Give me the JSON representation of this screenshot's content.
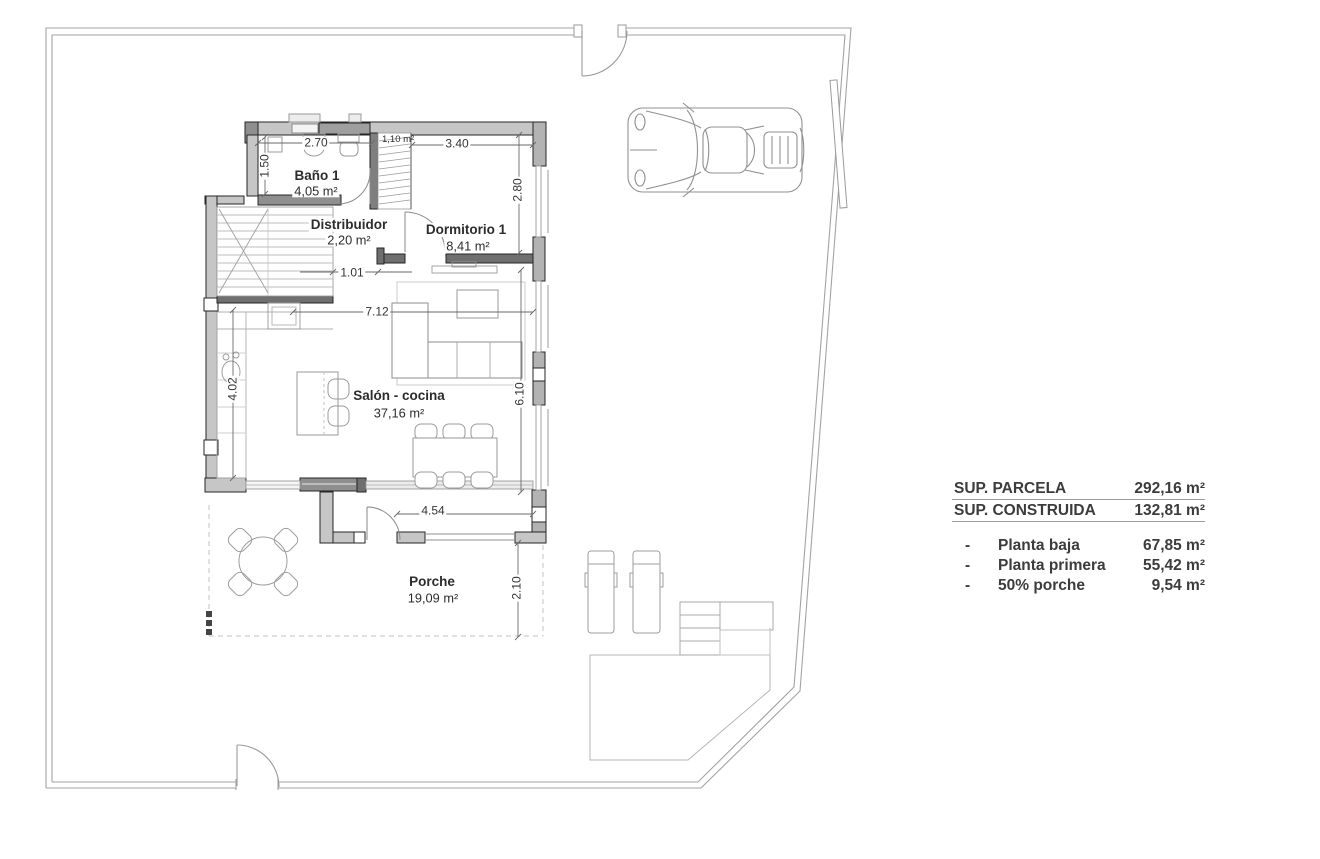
{
  "rooms": {
    "bano": {
      "name": "Baño 1",
      "area": "4,05 m²"
    },
    "distribuidor": {
      "name": "Distribuidor",
      "area": "2,20 m²"
    },
    "dormitorio": {
      "name": "Dormitorio 1",
      "area": "8,41 m²"
    },
    "salon": {
      "name": "Salón - cocina",
      "area": "37,16 m²"
    },
    "porche": {
      "name": "Porche",
      "area": "19,09 m²"
    },
    "armario": {
      "area": "1,10 m²"
    }
  },
  "dimensions": {
    "bano_width": "2.70",
    "bano_depth": "1.50",
    "dorm_width": "3.40",
    "dorm_depth": "2.80",
    "hall_width": "1.01",
    "salon_width": "7.12",
    "salon_depth": "6.10",
    "kitchen_depth": "4.02",
    "porche_width": "4.54",
    "porche_depth": "2.10"
  },
  "summary": {
    "totals": [
      {
        "label": "SUP. PARCELA",
        "value": "292,16 m²"
      },
      {
        "label": "SUP. CONSTRUIDA",
        "value": "132,81 m²"
      }
    ],
    "breakdown": [
      {
        "bullet": "-",
        "label": "Planta baja",
        "value": "67,85 m²"
      },
      {
        "bullet": "-",
        "label": "Planta primera",
        "value": "55,42 m²"
      },
      {
        "bullet": "-",
        "label": "50% porche",
        "value": "9,54 m²"
      }
    ]
  },
  "colors": {
    "wall_fill": "#c6c6c6",
    "wall_dark": "#8f8f8f",
    "boundary_line": "#a3a3a3",
    "text": "#3c3c3c"
  }
}
